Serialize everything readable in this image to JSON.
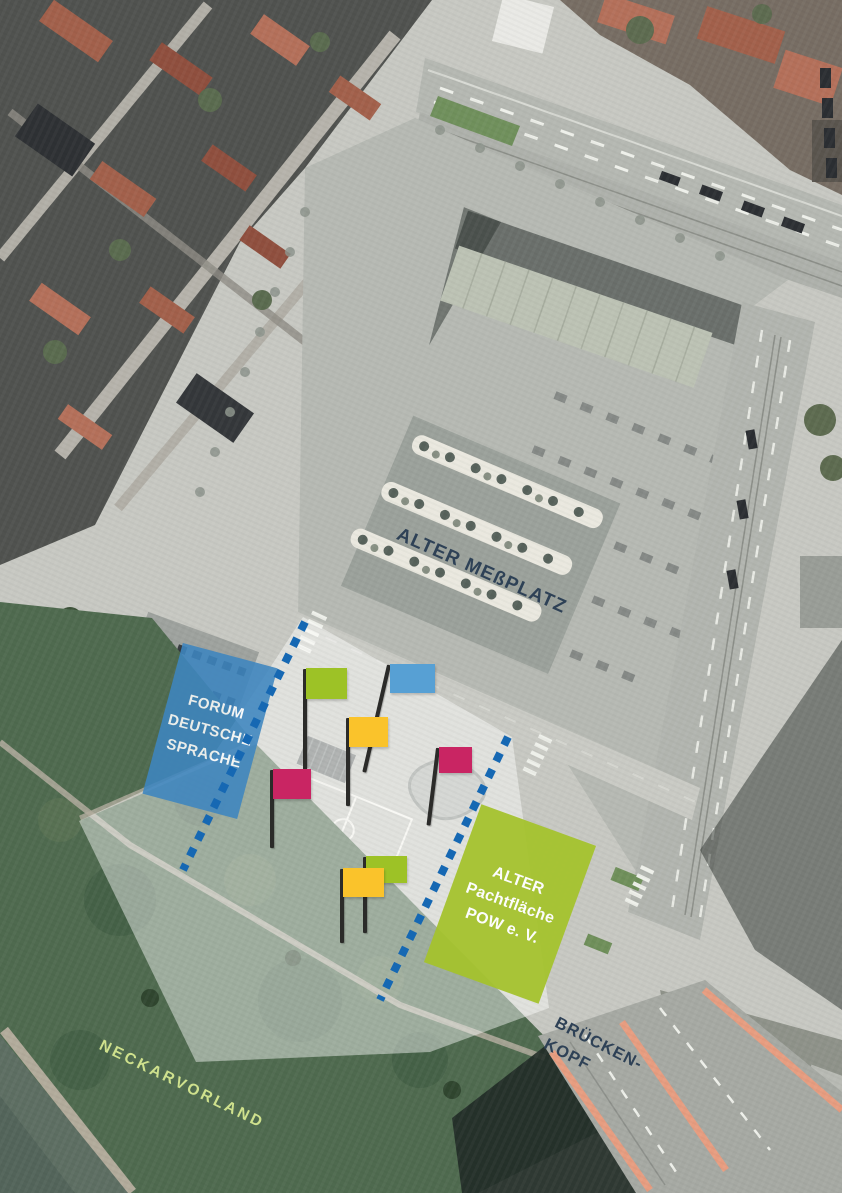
{
  "palette": {
    "flag_green": "#9dc226",
    "flag_blue": "#57a0d4",
    "flag_yellow": "#fac32b",
    "flag_pink": "#c92563",
    "zone_forum_blue": "#3e86c0",
    "zone_pow_green": "#a5c32d",
    "boundary_blue": "#1668b3",
    "label_dark": "#2e4156",
    "label_light_green": "#cfe18d"
  },
  "labels": {
    "messplatz": "ALTER MEßPLATZ",
    "neckarvorland": "NECKARVORLAND",
    "brueckenkopf": [
      "BRÜCKEN-",
      "KOPF"
    ]
  },
  "zones": [
    {
      "name": "forum-deutsche-sprache",
      "lines": [
        "FORUM",
        "DEUTSCHE",
        "SPRACHE"
      ],
      "color": "#3e86c0"
    },
    {
      "name": "alter-pachtflaeche-pow",
      "lines": [
        "ALTER",
        "Pachtfläche",
        "POW e. V."
      ],
      "color": "#a5c32d"
    }
  ],
  "flags": [
    {
      "name": "flag-green-1",
      "color": "#9dc226"
    },
    {
      "name": "flag-blue-1",
      "color": "#57a0d4"
    },
    {
      "name": "flag-yellow-1",
      "color": "#fac32b"
    },
    {
      "name": "flag-pink-1",
      "color": "#c92563"
    },
    {
      "name": "flag-pink-2",
      "color": "#c92563"
    },
    {
      "name": "flag-green-2",
      "color": "#9dc226"
    },
    {
      "name": "flag-yellow-2",
      "color": "#fac32b"
    }
  ]
}
